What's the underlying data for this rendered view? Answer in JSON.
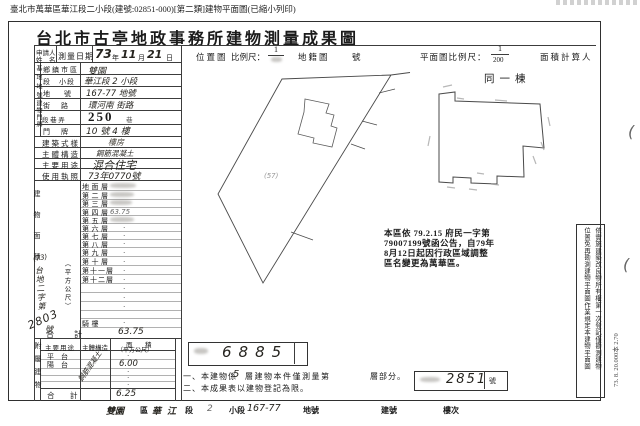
{
  "top_caption": "臺北市萬華區華江段二小段(建號:02851-000)[第二類]建物平面圖(已縮小列印)",
  "title": "台北市古亭地政事務所建物測量成果圖",
  "header": {
    "applicant_label_1": "申請人",
    "applicant_label_2": "姓　名",
    "survey_date_label": "測量日期",
    "date_year": "73",
    "date_year_unit": "年",
    "date_month": "11",
    "date_month_unit": "月",
    "date_day": "21",
    "date_day_unit": "日",
    "location_map_label": "位置圖",
    "scale_label": "比例尺：",
    "location_scale_numerator": "1",
    "cadastral_map_label": "地籍圖",
    "cadastral_no_label": "號",
    "plan_scale_label": "平面圖比例尺：",
    "plan_scale_numerator": "1",
    "plan_scale_denominator": "200",
    "area_calculator_label": "面積計算人"
  },
  "site": {
    "section_label": "基地地號",
    "rows": [
      {
        "label": "鄉鎮市區",
        "value": "雙園"
      },
      {
        "label": "段　小段",
        "value": "華江段 2 小段"
      },
      {
        "label": "地　　號",
        "value": "167-77 地號"
      }
    ]
  },
  "address": {
    "section_label": "建物門牌",
    "street_label": "街　路",
    "street_value": "環河南 街路",
    "lane_label": "段 巷 弄",
    "lane_number": "250",
    "lane_unit": "巷",
    "door_label": "門　牌",
    "door_value": "10 號 4 樓"
  },
  "attributes": {
    "rows": [
      {
        "label": "建築式樣",
        "value": "樓房"
      },
      {
        "label": "主體構造",
        "value": "鋼筋混凝土"
      },
      {
        "label": "主要用途",
        "value": "混合住宅"
      },
      {
        "label": "使用執照",
        "value": "73年0770號"
      }
    ]
  },
  "building_area": {
    "section_label": "建物面積",
    "unit_label": "（平方公尺）",
    "floors": [
      {
        "label": "地面層",
        "value": ""
      },
      {
        "label": "第二層",
        "value": ""
      },
      {
        "label": "第三層",
        "value": ""
      },
      {
        "label": "第四層",
        "value": "63.75"
      },
      {
        "label": "第五層",
        "value": ""
      },
      {
        "label": "第六層",
        "value": "·"
      },
      {
        "label": "第七層",
        "value": "·"
      },
      {
        "label": "第八層",
        "value": "·"
      },
      {
        "label": "第九層",
        "value": "·"
      },
      {
        "label": "第十層",
        "value": "·"
      },
      {
        "label": "第十一層",
        "value": "·"
      },
      {
        "label": "第十二層",
        "value": "·"
      },
      {
        "label": "騎樓",
        "value": "·"
      }
    ],
    "filler": [
      "·",
      "·",
      "·"
    ],
    "total_label": "合　計",
    "total_value": "63.75"
  },
  "annex": {
    "section_label": "附屬建物",
    "use_header": "主要用途",
    "structure_header": "主體構造",
    "area_header_1": "面　積",
    "area_header_2": "（平方公尺）",
    "structure_value": "鋼筋混凝土",
    "rows": [
      {
        "label": "平　台",
        "value": "·"
      },
      {
        "label": "陽　台",
        "value": "6.00"
      },
      {
        "label": "",
        "value": "·"
      },
      {
        "label": "",
        "value": "·"
      },
      {
        "label": "",
        "value": "·"
      }
    ],
    "total_label": "合　計",
    "total_value": "6.25"
  },
  "file_stamp": {
    "prefix": "(73)",
    "body": "台地二字第",
    "number": "2803",
    "suffix": "號"
  },
  "result_box": {
    "number": "6885"
  },
  "building_no_box": {
    "number": "2851",
    "unit": "號"
  },
  "floor_note": {
    "line1_a": "一、本建物係",
    "line1_hand": "5",
    "line1_b": "層建物本件僅測量第",
    "line1_c": "層部分。",
    "line2": "二、本成果表以建物登記為限。"
  },
  "district_note": {
    "line1": "本區依 79.2.15 府民一字第",
    "line2": "79007199號函公告，自79年",
    "line3": "8月12日起因行政區域調整",
    "line4": "區名變更為萬華區。"
  },
  "floor_plan": {
    "same_building_label": "同一棟"
  },
  "location_map": {
    "parcel_label": "(57)"
  },
  "right_margin": {
    "note_col_1": "依實施建築改良物所有權第一次登記僅勘測建物",
    "note_col_2": "位置免再勘測建物平面圖作業規定本建物平面圖",
    "print_code": "73. 8. 20.000本 2.70",
    "paren_1": "(",
    "paren_2": "("
  },
  "bottom_strip": {
    "items": [
      "雙園",
      "區",
      "華江",
      "段",
      "2",
      "小段",
      "167-77",
      "地號",
      "建號",
      "樓次"
    ]
  },
  "colors": {
    "ink": "#1b1b1b",
    "hand": "#26241f",
    "pencil": "#6a6a6a",
    "line": "#3c3c3c",
    "paper": "#ffffff"
  }
}
